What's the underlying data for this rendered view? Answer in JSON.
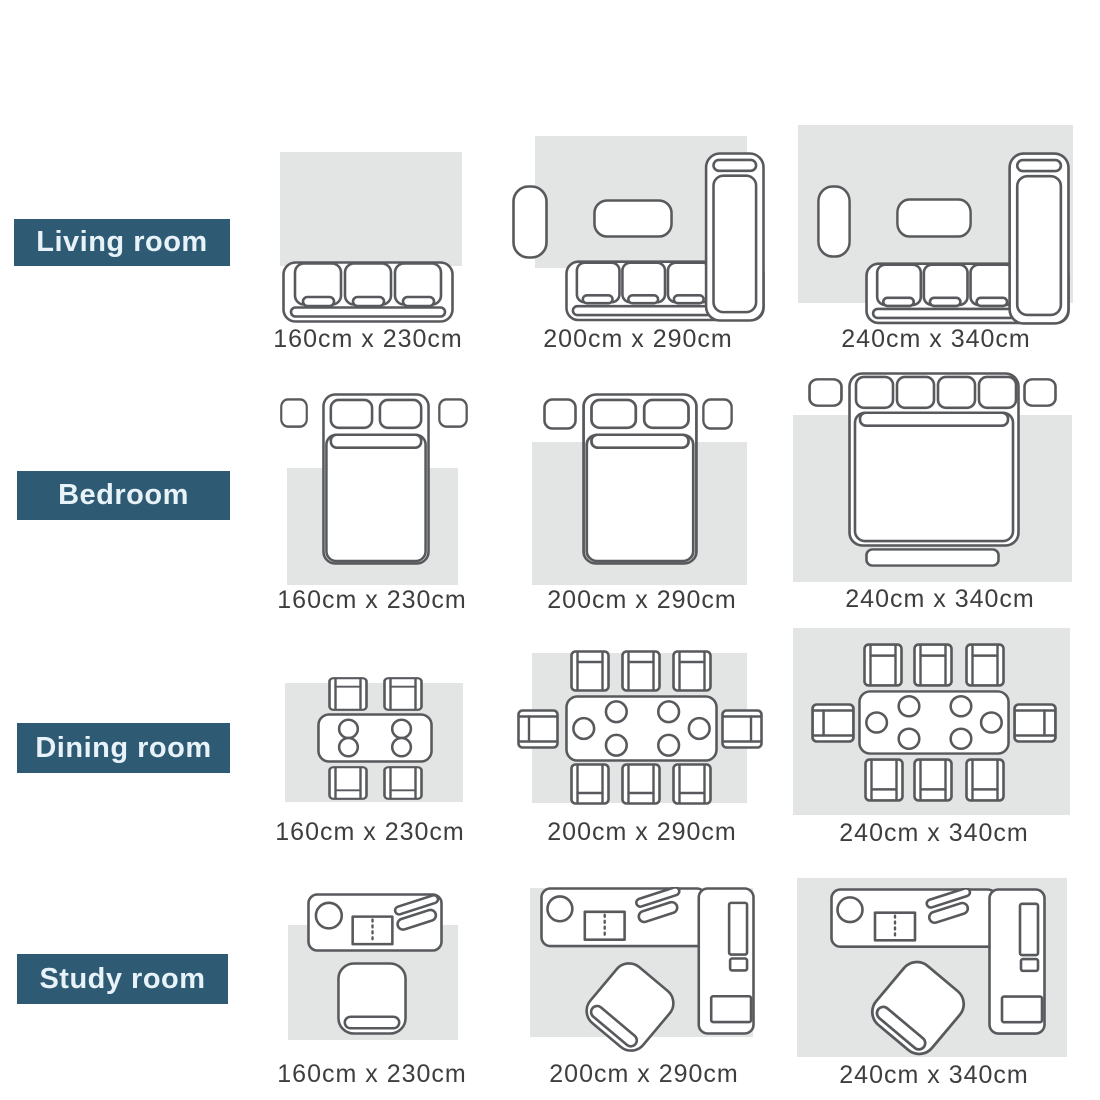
{
  "colors": {
    "label_background": "#2e5a73",
    "label_text": "#e7f2f9",
    "rug_fill": "#e3e4e4",
    "furniture_outline": "#57595c",
    "caption_text": "#3d3e40"
  },
  "rows": [
    {
      "label": "Living room",
      "sizes": [
        "160cm x 230cm",
        "200cm x 290cm",
        "240cm x 340cm"
      ]
    },
    {
      "label": "Bedroom",
      "sizes": [
        "160cm x 230cm",
        "200cm x 290cm",
        "240cm x 340cm"
      ]
    },
    {
      "label": "Dining room",
      "sizes": [
        "160cm x 230cm",
        "200cm x 290cm",
        "240cm x 340cm"
      ]
    },
    {
      "label": "Study room",
      "sizes": [
        "160cm x 230cm",
        "200cm x 290cm",
        "240cm x 340cm"
      ]
    }
  ]
}
